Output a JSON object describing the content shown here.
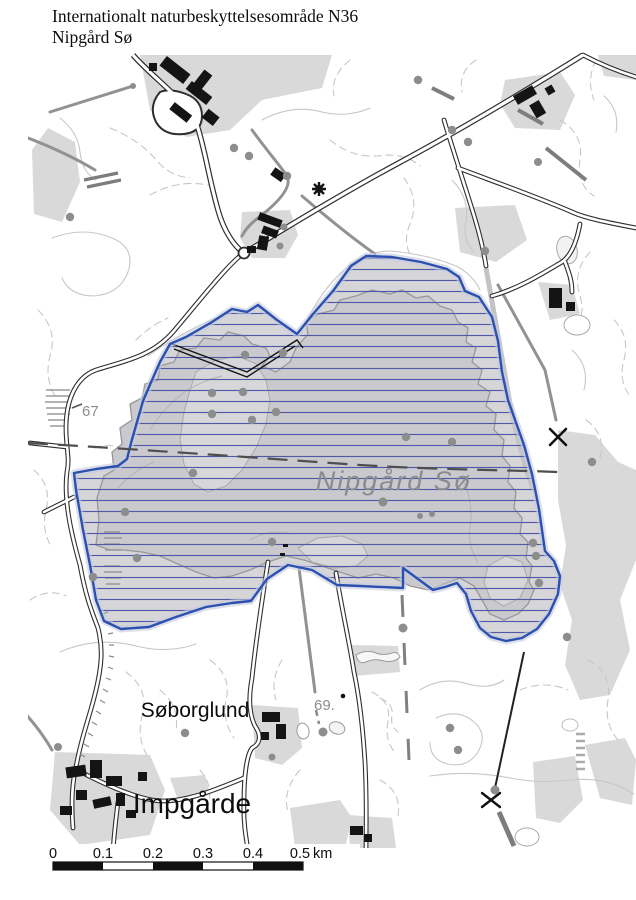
{
  "header": {
    "title_line1": "Internationalt naturbeskyttelsesområde N36",
    "title_line2": "Nipgård Sø"
  },
  "map": {
    "lake_label": "Nipgård Sø",
    "place_labels": {
      "farm_north": "Søborglund",
      "village_south": "Impgårde"
    },
    "elevation_labels": {
      "west": "67",
      "south": "69."
    },
    "legend_colors": {
      "protection_boundary": "#2b50b0",
      "protection_hatch": "#5058a8",
      "lake_fill": "#cacace",
      "field_fill": "#d9d9d9"
    }
  },
  "scalebar": {
    "ticks": [
      "0",
      "0.1",
      "0.2",
      "0.3",
      "0.4",
      "0.5"
    ],
    "unit": "km"
  }
}
